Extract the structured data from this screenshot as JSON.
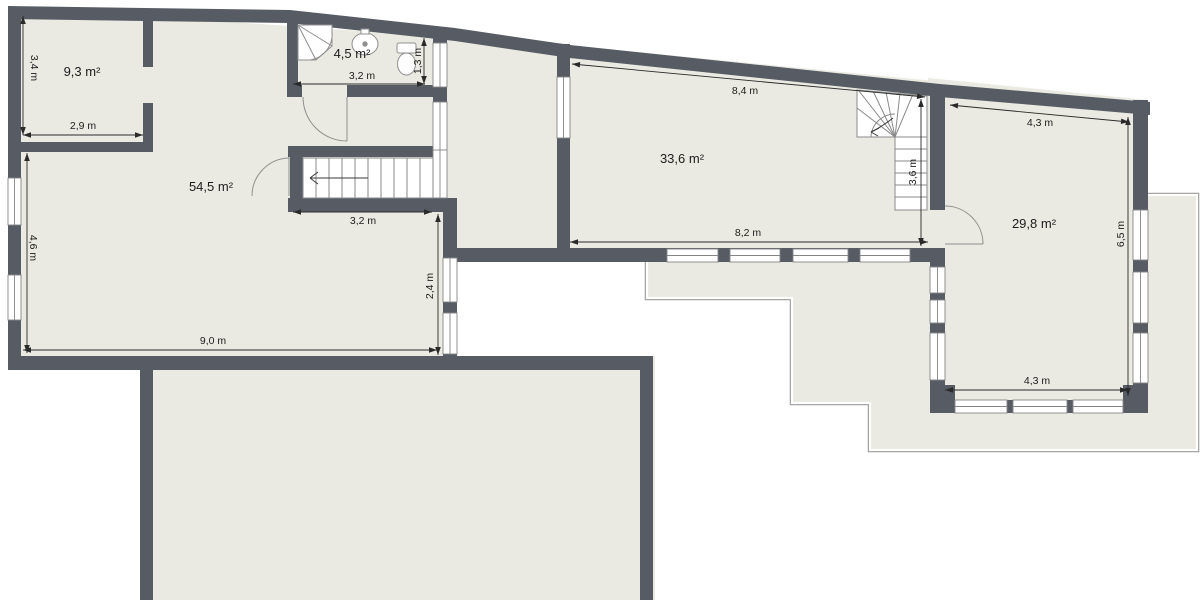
{
  "page": {
    "type": "floor-plan",
    "background": "#ffffff"
  },
  "colors": {
    "wall": "#575c64",
    "floor": "#eaeae2",
    "terrace_outline": "#9c9c9a",
    "dimension": "#2a2a2a",
    "window_frame": "#848484"
  },
  "rooms": {
    "top_left": {
      "area": "9,3 m²",
      "width": "2,9 m",
      "height": "3,4 m"
    },
    "bathroom": {
      "area": "4,5 m²",
      "width": "3,2 m",
      "height": "1,3 m"
    },
    "living": {
      "area": "54,5 m²",
      "height": "4,6 m",
      "width": "9,0 m",
      "stairs_width": "3,2 m",
      "side": "2,4 m"
    },
    "middle": {
      "area": "33,6 m²",
      "top": "8,4 m",
      "bottom": "8,2 m",
      "stairs_height": "3,6 m"
    },
    "right": {
      "area": "29,8 m²",
      "top": "4,3 m",
      "right_side": "6,5 m",
      "bottom": "4,3 m"
    }
  },
  "fixtures": [
    "shower",
    "sink",
    "toilet",
    "straight-stairs",
    "winder-stairs"
  ]
}
